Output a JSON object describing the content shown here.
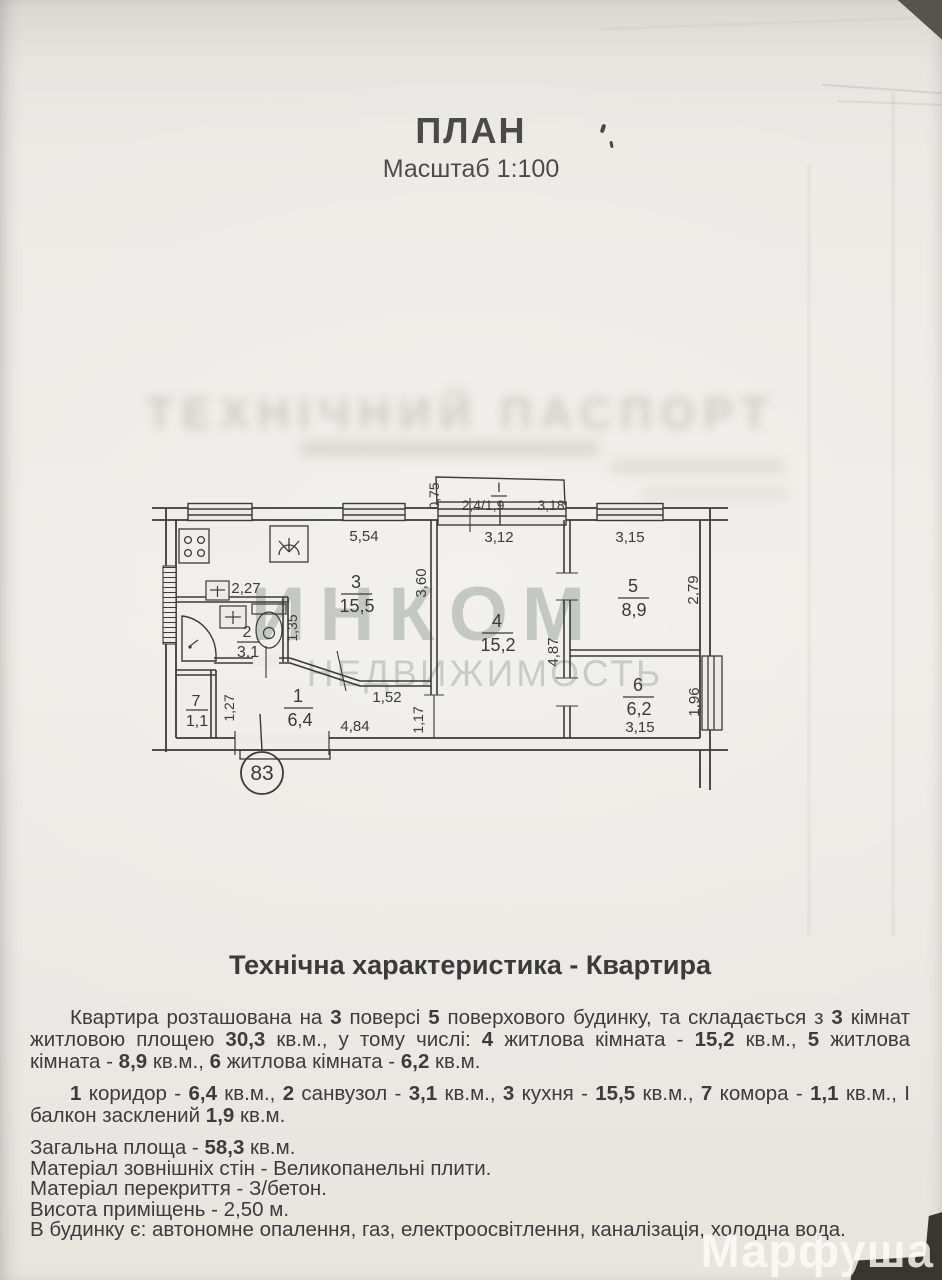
{
  "header": {
    "title": "ПЛАН",
    "scale": "Масштаб 1:100"
  },
  "ghost": {
    "line1": "ТЕХНІЧНИЙ ПАСПОРТ"
  },
  "watermark": {
    "line1": "ИНКОМ",
    "line2": "НЕДВИЖИМОСТЬ"
  },
  "plan": {
    "apartment_number": "83",
    "balcony": {
      "label": "І",
      "height": "0,75",
      "window": "2,4/1,9",
      "right": "3,18"
    },
    "rooms": [
      {
        "num": "1",
        "area": "6,4"
      },
      {
        "num": "2",
        "area": "3,1"
      },
      {
        "num": "3",
        "area": "15,5"
      },
      {
        "num": "4",
        "area": "15,2"
      },
      {
        "num": "5",
        "area": "8,9"
      },
      {
        "num": "6",
        "area": "6,2"
      },
      {
        "num": "7",
        "area": "1,1"
      }
    ],
    "dims": {
      "kitchen_top": "5,54",
      "kitchen_right": "3,60",
      "san_top": "2,27",
      "san_right": "1,35",
      "pantry_right": "1,27",
      "hall_diag": "1,52",
      "hall_bottom": "4,84",
      "hall_right": "1,17",
      "room4_top": "3,12",
      "room4_right": "4,87",
      "room5_top": "3,15",
      "room5_right": "2,79",
      "room6_right": "1,96",
      "room6_bottom": "3,15"
    }
  },
  "description": {
    "heading": "Технічна характеристика - Квартира",
    "p1": [
      {
        "t": "Квартира розташована на "
      },
      {
        "t": "3",
        "b": 1
      },
      {
        "t": " поверсі "
      },
      {
        "t": "5",
        "b": 1
      },
      {
        "t": " поверхового будинку, та складається з "
      },
      {
        "t": "3",
        "b": 1
      },
      {
        "t": " кімнат житловою площею "
      },
      {
        "t": "30,3",
        "b": 1
      },
      {
        "t": " кв.м., у тому числі: "
      },
      {
        "t": "4",
        "b": 1
      },
      {
        "t": " житлова кімната - "
      },
      {
        "t": "15,2",
        "b": 1
      },
      {
        "t": " кв.м., "
      },
      {
        "t": "5",
        "b": 1
      },
      {
        "t": " житлова кімната - "
      },
      {
        "t": "8,9",
        "b": 1
      },
      {
        "t": " кв.м., "
      },
      {
        "t": "6",
        "b": 1
      },
      {
        "t": " житлова кімната - "
      },
      {
        "t": "6,2",
        "b": 1
      },
      {
        "t": " кв.м."
      }
    ],
    "p2": [
      {
        "t": "1",
        "b": 1
      },
      {
        "t": " коридор - "
      },
      {
        "t": "6,4",
        "b": 1
      },
      {
        "t": " кв.м., "
      },
      {
        "t": "2",
        "b": 1
      },
      {
        "t": " санвузол - "
      },
      {
        "t": "3,1",
        "b": 1
      },
      {
        "t": " кв.м., "
      },
      {
        "t": "3",
        "b": 1
      },
      {
        "t": " кухня - "
      },
      {
        "t": "15,5",
        "b": 1
      },
      {
        "t": " кв.м., "
      },
      {
        "t": "7",
        "b": 1
      },
      {
        "t": " комора - "
      },
      {
        "t": "1,1",
        "b": 1
      },
      {
        "t": " кв.м., І балкон засклений "
      },
      {
        "t": "1,9",
        "b": 1
      },
      {
        "t": " кв.м."
      }
    ],
    "p3": [
      {
        "t": "Загальна площа - "
      },
      {
        "t": "58,3",
        "b": 1
      },
      {
        "t": " кв.м."
      }
    ],
    "p4": "Матеріал зовнішніх стін - Великопанельні плити.",
    "p5": "Матеріал перекриття - З/бетон.",
    "p6": "Висота приміщень - 2,50 м.",
    "p7": "В будинку є: автономне опалення, газ, електроосвітлення, каналізація, холодна вода."
  },
  "overlay": {
    "photo_watermark": "Марфуша"
  }
}
